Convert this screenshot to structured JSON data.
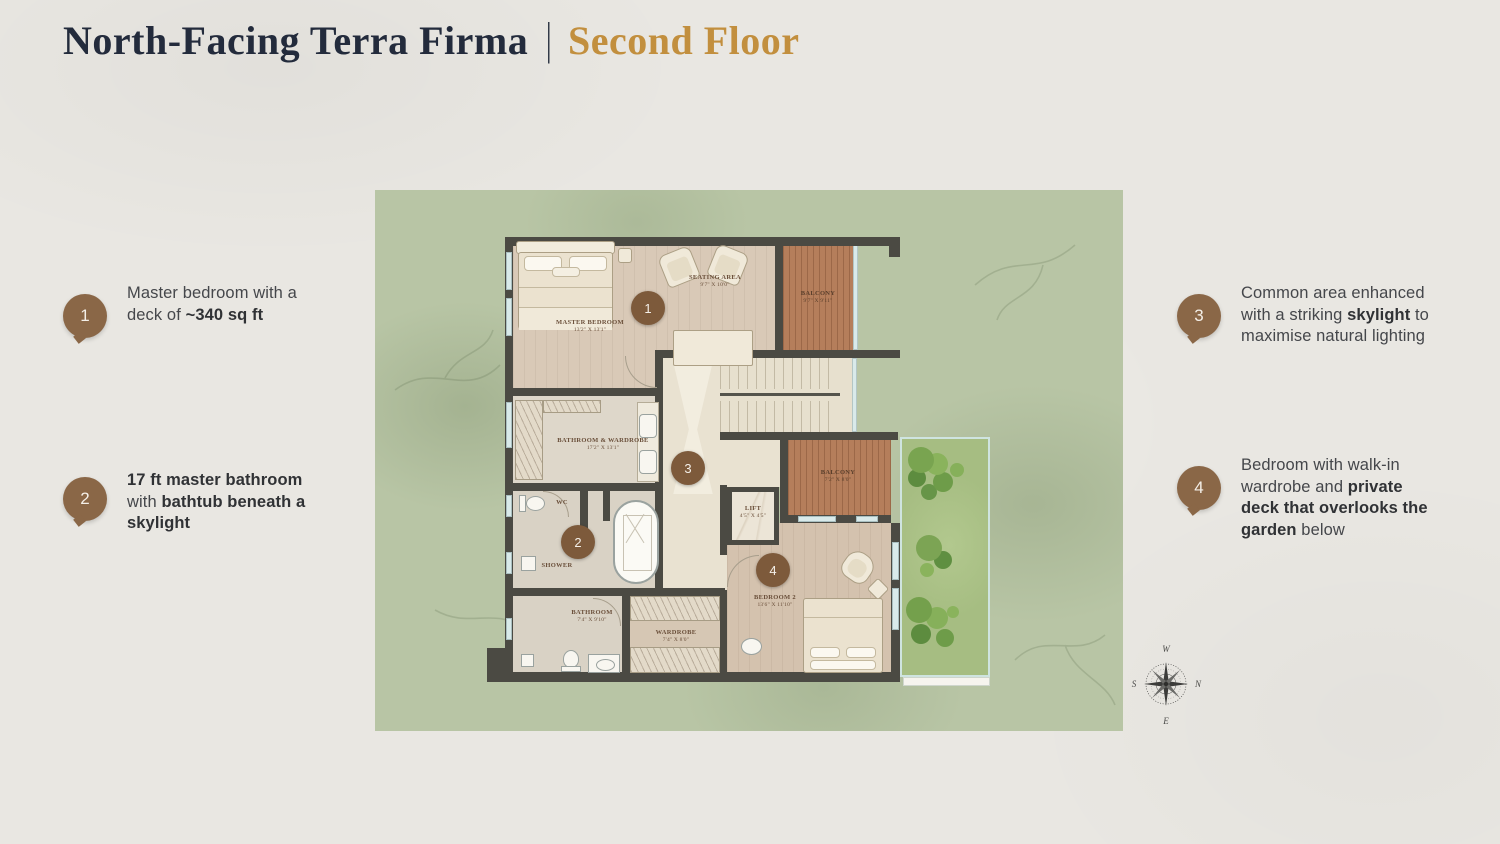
{
  "title": {
    "main": "North-Facing Terra Firma",
    "divider": "|",
    "accent": "Second Floor"
  },
  "callouts": [
    {
      "number": "1",
      "segments": [
        {
          "t": "Master bedroom with a deck of ",
          "b": false
        },
        {
          "t": "~340 sq ft",
          "b": true
        }
      ]
    },
    {
      "number": "2",
      "segments": [
        {
          "t": "17 ft master bathroom",
          "b": true
        },
        {
          "t": " with ",
          "b": false
        },
        {
          "t": "bathtub beneath a skylight",
          "b": true
        }
      ]
    },
    {
      "number": "3",
      "segments": [
        {
          "t": "Common area enhanced with a striking ",
          "b": false
        },
        {
          "t": "skylight",
          "b": true
        },
        {
          "t": " to maximise natural lighting",
          "b": false
        }
      ]
    },
    {
      "number": "4",
      "segments": [
        {
          "t": "Bedroom with walk-in wardrobe and ",
          "b": false
        },
        {
          "t": "private deck that overlooks the garden",
          "b": true
        },
        {
          "t": " below",
          "b": false
        }
      ]
    }
  ],
  "plan": {
    "markers": {
      "1": "1",
      "2": "2",
      "3": "3",
      "4": "4"
    },
    "rooms": {
      "master_bedroom": {
        "name": "MASTER BEDROOM",
        "dims": "13'2\" x 13'1\""
      },
      "seating_area": {
        "name": "SEATING AREA",
        "dims": "9'7\" x 10'0\""
      },
      "balcony_top": {
        "name": "BALCONY",
        "dims": "9'7\" x 9'11\""
      },
      "bathroom_wardrobe": {
        "name": "BATHROOM & WARDROBE",
        "dims": "17'2\" x 13'1\""
      },
      "lift": {
        "name": "LIFT",
        "dims": "4'5\" x 4'5\""
      },
      "balcony_mid": {
        "name": "BALCONY",
        "dims": "7'2\" x 8'0\""
      },
      "wc": {
        "name": "WC",
        "dims": ""
      },
      "shower": {
        "name": "SHOWER",
        "dims": ""
      },
      "bathroom": {
        "name": "BATHROOM",
        "dims": "7'4\" x 9'10\""
      },
      "wardrobe": {
        "name": "WARDROBE",
        "dims": "7'4\" x 8'0\""
      },
      "bedroom_2": {
        "name": "BEDROOM 2",
        "dims": "13'6\" x 11'10\""
      }
    }
  },
  "compass": {
    "n": "N",
    "e": "E",
    "s": "S",
    "w": "W"
  },
  "colors": {
    "accent_gold": "#c28f3e",
    "title_ink": "#232b3c",
    "callout_brown": "#8a6747",
    "marker_brown": "#7d5a3b",
    "map_green": "#b8c5a5"
  }
}
